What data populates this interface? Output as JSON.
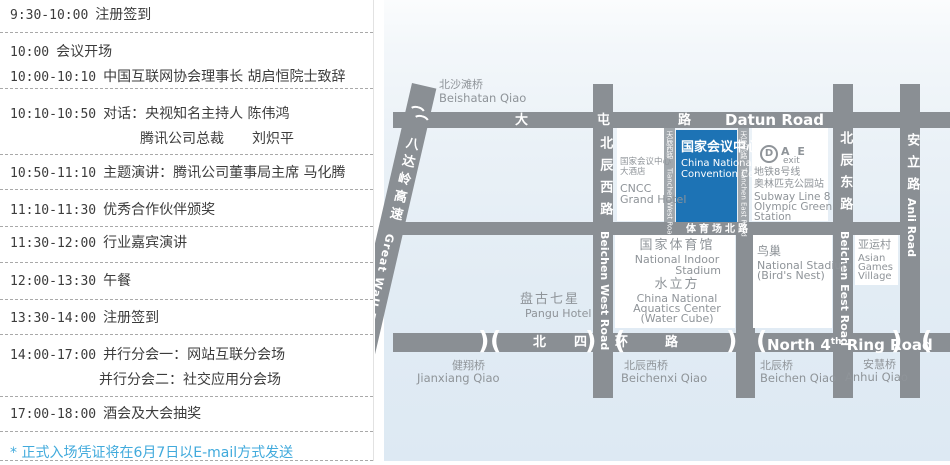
{
  "colors": {
    "accent_blue": "#1d73b5",
    "road_gray": "#8a8f94",
    "map_label_gray": "#8f9499",
    "footnote_blue": "#41aadc",
    "map_background_blue": "#dde9f3"
  },
  "schedule": {
    "rows": [
      {
        "lines": [
          {
            "time": "9:30-10:00",
            "text": "注册签到"
          }
        ]
      },
      {
        "lines": [
          {
            "time": "10:00",
            "text": "会议开场"
          },
          {
            "time": "10:00-10:10",
            "text": "中国互联网协会理事长 胡启恒院士致辞"
          }
        ]
      },
      {
        "lines": [
          {
            "time": "10:10-10:50",
            "text": "对话：央视知名主持人 陈伟鸿"
          },
          {
            "time": "",
            "text": "腾讯公司总裁　　刘炽平"
          }
        ]
      },
      {
        "lines": [
          {
            "time": "10:50-11:10",
            "text": "主题演讲：腾讯公司董事局主席 马化腾"
          }
        ]
      },
      {
        "lines": [
          {
            "time": "11:10-11:30",
            "text": "优秀合作伙伴颁奖"
          }
        ]
      },
      {
        "lines": [
          {
            "time": "11:30-12:00",
            "text": "行业嘉宾演讲"
          }
        ]
      },
      {
        "lines": [
          {
            "time": "12:00-13:30",
            "text": "午餐"
          }
        ]
      },
      {
        "lines": [
          {
            "time": "13:30-14:00",
            "text": "注册签到"
          }
        ]
      },
      {
        "lines": [
          {
            "time": "14:00-17:00",
            "text": "并行分会一：网站互联分会场"
          },
          {
            "time": "",
            "text": "并行分会二：社交应用分会场"
          }
        ]
      },
      {
        "lines": [
          {
            "time": "17:00-18:00",
            "text": "酒会及大会抽奖"
          }
        ]
      }
    ],
    "footnote": "* 正式入场凭证将在6月7日以E-mail方式发送"
  },
  "map": {
    "roads": {
      "datun": {
        "zh1": "大",
        "zh2": "屯",
        "zh3": "路",
        "en": "Datun Road"
      },
      "ring": {
        "zh1": "北",
        "zh2": "四",
        "zh3": "环",
        "zh4": "路",
        "en1": "North 4",
        "sup": "th",
        "en2": " Ring Road"
      },
      "stadium_north": {
        "zh": "体育场北路"
      },
      "beichen_west": {
        "zh": "北辰西路",
        "en": "Beichen West Road"
      },
      "beichen_east": {
        "zh": "北辰东路",
        "en": "Beichen Eest Road"
      },
      "anli": {
        "zh": "安立路",
        "en": "Anli Road"
      },
      "tianchen_west": {
        "zh": "天辰西路",
        "en": "Tianchen West Road"
      },
      "tianchen_east": {
        "zh": "天辰东路",
        "en": "Tianchen East Road"
      },
      "badaling": {
        "zh": "八达岭高速",
        "en": "Great Wall Expressway"
      }
    },
    "places": {
      "beishatan_qiao": {
        "zh": "北沙滩桥",
        "en": "Beishatan Qiao"
      },
      "cncc_hotel": {
        "zh1": "国家会议中心",
        "zh2": "大酒店",
        "en1": "CNCC",
        "en2": "Grand Hotel"
      },
      "convention_center": {
        "zh": "国家会议中心",
        "en1": "China National",
        "en2": "Convention Center"
      },
      "subway": {
        "logo": "D",
        "letters": "A E",
        "exit": "exit",
        "zh1": "地铁8号线",
        "zh2": "奥林匹克公园站",
        "en1": "Subway Line 8",
        "en2": "Olympic Green",
        "en3": "Station"
      },
      "indoor_stadium": {
        "zh": "国家体育馆",
        "en1": "National Indoor",
        "en2": "Stadium"
      },
      "water_cube": {
        "zh": "水立方",
        "en1": "China National",
        "en2": "Aquatics Center",
        "en3": "(Water Cube)"
      },
      "birds_nest": {
        "zh": "鸟巢",
        "en1": "National Stadium",
        "en2": "(Bird's Nest)"
      },
      "asian_games_village": {
        "zh": "亚运村",
        "en1": "Asian",
        "en2": "Games",
        "en3": "Village"
      },
      "pangu_hotel": {
        "zh": "盘古七星",
        "en": "Pangu Hotel"
      },
      "jianxiang_qiao": {
        "zh": "健翔桥",
        "en": "Jianxiang Qiao"
      },
      "beichenxi_qiao": {
        "zh": "北辰西桥",
        "en": "Beichenxi Qiao"
      },
      "beichen_qiao": {
        "zh": "北辰桥",
        "en": "Beichen Qiao"
      },
      "anhui_qiao": {
        "zh": "安慧桥",
        "en": "Anhui Qiao"
      }
    }
  }
}
